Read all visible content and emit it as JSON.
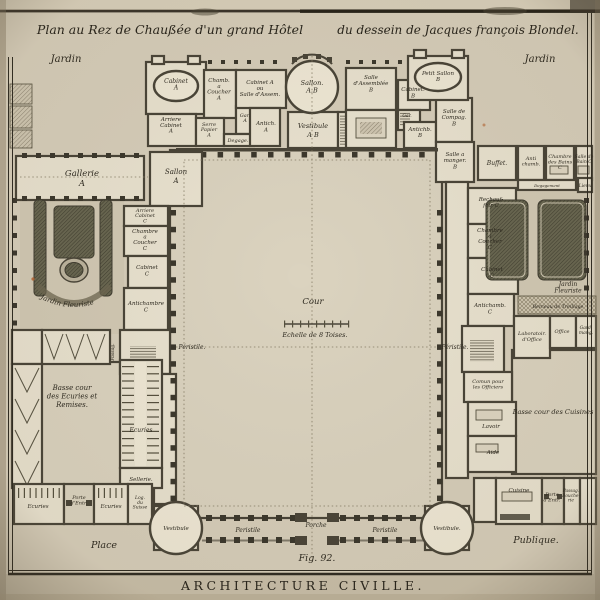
{
  "colors": {
    "paper": "#d7ceba",
    "ink": "#2e2a20",
    "wall": "#4a4538",
    "room": "#e9e2cf",
    "court": "#dbd3bf",
    "garden_bed": "#696751"
  },
  "labels": {
    "title_left": "Plan au Rez de Chaußée d'un grand Hôtel",
    "title_right": "du dessein de Jacques françois Blondel.",
    "jardin_left": "Jardin",
    "jardin_right": "Jardin",
    "cabinet_a": "Cabinet\nA",
    "chamb_coucher_a": "Chamb.\na\nCoucher\nA",
    "cabinet_ou_salle": "Cabinet A\nou\nSalle d'Assem.",
    "sallon_ab": "Sallon.\nA.B",
    "arriere_cabinet_a": "Arriere\nCabinet\nA",
    "serre_papier": "Serre\nPapier\nA",
    "gar_a": "Gar.\nA",
    "degage": "Degage.",
    "antich_a": "Antich.\nA",
    "vestibule_ab": "Vestibule\nA B",
    "salle_assemblee_b": "Salle\nd'Assemblée\nB",
    "cabinet_b": "Cabinet.\nB",
    "petit_sallon_b": "Petit Sallon\nB",
    "gar_b": "Gar.",
    "salle_compag_b": "Salle de\nCompag.\nB",
    "antichb_b": "Antichb.\nB",
    "salle_manger_b": "Salle a\nmanger.\nB",
    "gallerie_a": "Gallerie\nA",
    "sallon_a": "Sallon\nA",
    "arriere_cabinet_c": "Arriere\nCabinet\nC",
    "chambre_coucher_c": "Chambre\na\nCoucher\nC",
    "cabinet_c_left": "Cabinet\nC",
    "antichambre_c": "Antichambre\nC",
    "jardin_fleuriste_left": "Jardin Fleuriste",
    "peristile_left": "Péristile.",
    "passage_left": "Passag.",
    "basse_cour_ecuries": "Basse cour\ndes Ecuries et\nRemises.",
    "ecuries": "Ecuries",
    "sellerie": "Sellerie.",
    "ecuries_2": "Ecuries",
    "porte_entree_left": "Porte\nd'Entr.",
    "ecuries_3": "Ecuries",
    "log_du_suisse": "Log.\ndu\nSuisse",
    "vestibule_left": "Vestibule",
    "place": "Place",
    "peristile_bottom_left": "Peristile",
    "porche": "Porche",
    "peristile_bottom_right": "Peristile",
    "vestibule_right": "Vestibule.",
    "figure": "Fig. 92.",
    "cour": "Cour",
    "echelle": "Echelle de 8 Toises.",
    "buffet": "Buffet.",
    "antichamb_bains": "Anti\nchamb.",
    "chambre_des_bains": "Chambre\ndes Bains\nC",
    "salle_de_bain": "Salle de\nBain C",
    "lieux": "Lieux",
    "degagement": "Degagement",
    "rechauffoir": "Rechauf-\nfoir C",
    "chambre_coucher_right": "Chambre\na\nCoucher\nC",
    "cabinet_c_right": "Cabinet\nC",
    "antichamb_c_right": "Antichamb.\nC",
    "peristile_right": "Péristile.",
    "jardin_fleuriste_right": "Jardin\nFleuriste",
    "berceau": "Berceau de Treillage",
    "laboratoire_office": "Laboratoir.\nd'Office",
    "office": "Office",
    "garde_manger": "Gard.\nmang.",
    "comun_officiers": "Comun pour\nles Officiers",
    "lavoir": "Lavoir",
    "aide": "Aide",
    "basse_cour_cuisines": "Basse cour des Cuisines",
    "cuisine": "Cuisine",
    "porte_entree_right": "Porte\nd'Entr.",
    "passage_boucherie": "Passag.\nBouche-\nrie",
    "publique": "Publique.",
    "caption": "ARCHITECTURE CIVILLE."
  }
}
